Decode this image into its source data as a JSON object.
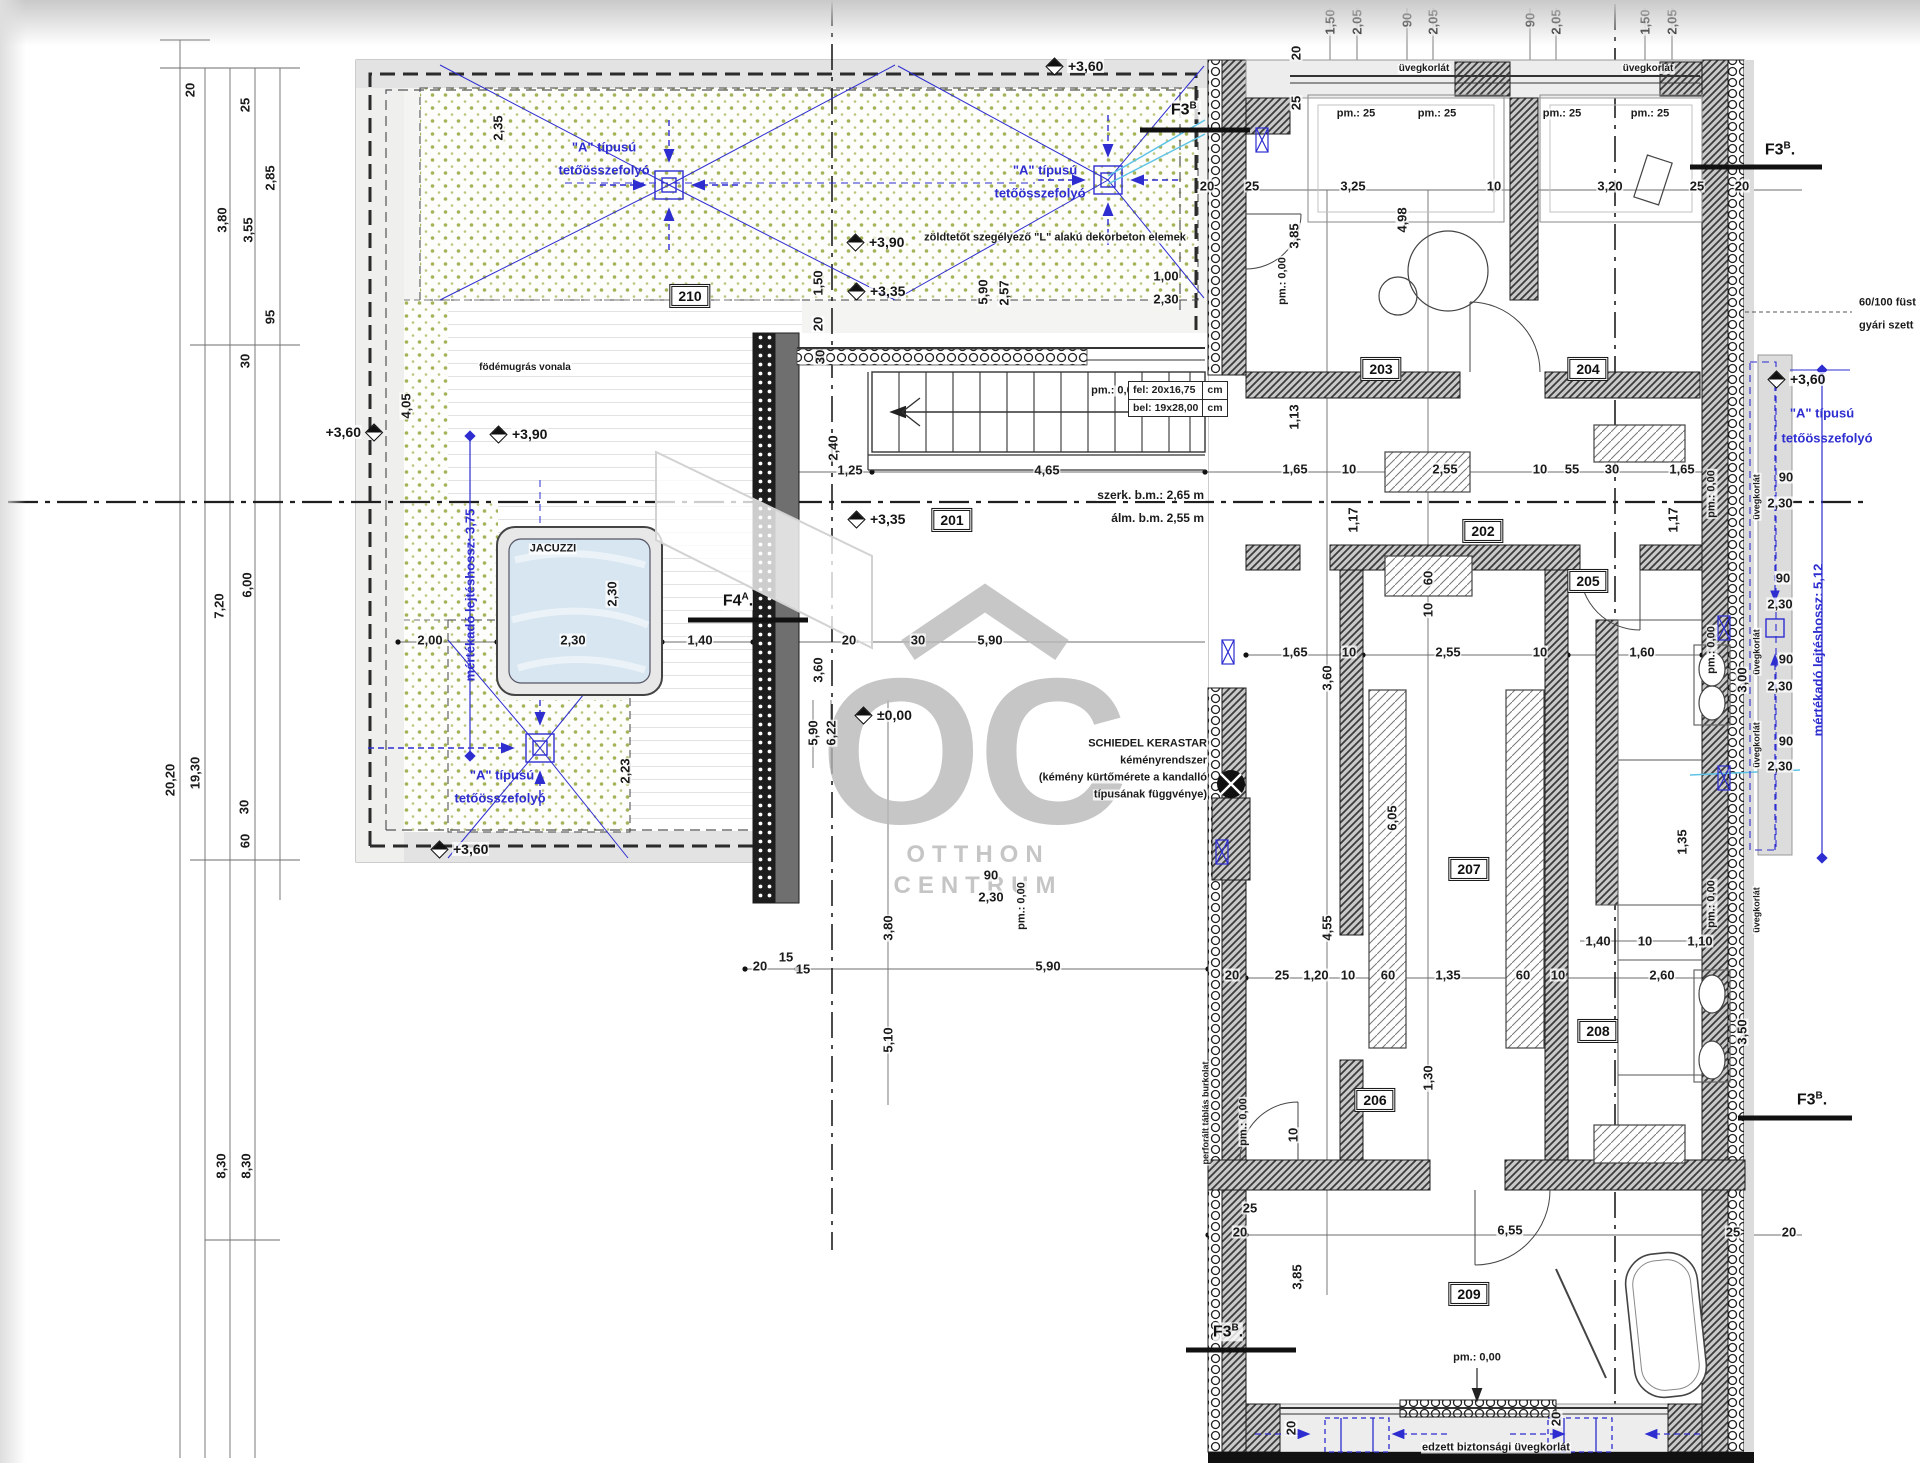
{
  "document": {
    "type": "architectural-floor-plan",
    "language": "hu"
  },
  "colors": {
    "annotation_blue": "#2d2dd0",
    "pipe_cyan": "#5ec4e6",
    "greenroof_dot": "#a6b257",
    "wall_dark": "#3c3c3c"
  },
  "watermark": {
    "logo": "OC",
    "line1": "OTTHON",
    "line2": "CENTRUM"
  },
  "rooms": [
    {
      "id": "201",
      "x": 952,
      "y": 520
    },
    {
      "id": "202",
      "x": 1483,
      "y": 531
    },
    {
      "id": "203",
      "x": 1381,
      "y": 369
    },
    {
      "id": "204",
      "x": 1588,
      "y": 369
    },
    {
      "id": "205",
      "x": 1588,
      "y": 581
    },
    {
      "id": "206",
      "x": 1375,
      "y": 1100
    },
    {
      "id": "207",
      "x": 1469,
      "y": 869
    },
    {
      "id": "208",
      "x": 1598,
      "y": 1031
    },
    {
      "id": "209",
      "x": 1469,
      "y": 1294
    },
    {
      "id": "210",
      "x": 690,
      "y": 296
    }
  ],
  "section_markers": [
    {
      "m": "F3",
      "sup": "B",
      "x": 1186,
      "y": 110
    },
    {
      "m": "F3",
      "sup": "B",
      "x": 1780,
      "y": 150
    },
    {
      "m": "F3",
      "sup": "B",
      "x": 1812,
      "y": 1100
    },
    {
      "m": "F3",
      "sup": "B",
      "x": 1228,
      "y": 1332
    },
    {
      "m": "F4",
      "sup": "A",
      "x": 738,
      "y": 601
    }
  ],
  "elevation_markers": [
    {
      "t": "+3,60",
      "x": 1055,
      "y": 66
    },
    {
      "t": "+3,90",
      "x": 856,
      "y": 242
    },
    {
      "t": "+3,35",
      "x": 857,
      "y": 291
    },
    {
      "t": "+3,60",
      "x": 367,
      "y": 432,
      "side": "l"
    },
    {
      "t": "+3,90",
      "x": 499,
      "y": 434
    },
    {
      "t": "+3,35",
      "x": 857,
      "y": 519
    },
    {
      "t": "±0,00",
      "x": 864,
      "y": 715
    },
    {
      "t": "+3,60",
      "x": 440,
      "y": 849
    },
    {
      "t": "+3,60",
      "x": 1777,
      "y": 379
    }
  ],
  "stair_note": {
    "l1": "fel:",
    "v1": "20x16,75",
    "l2": "bel:",
    "v2": "19x28,00",
    "u1": "cm",
    "u2": "cm"
  },
  "labels": [
    {
      "t": "zöldtetőt szegélyező \"L\" alakú dekorbeton elemek",
      "x": 1055,
      "y": 238,
      "s": 11
    },
    {
      "t": "födémugrás vonala",
      "x": 525,
      "y": 368,
      "s": 10
    },
    {
      "t": "szerk. b.m.: 2,65 m",
      "x": 1205,
      "y": 495,
      "s": 12,
      "a": "r"
    },
    {
      "t": "álm. b.m. 2,55 m",
      "x": 1205,
      "y": 518,
      "s": 12,
      "a": "r"
    },
    {
      "t": "üvegkorlát",
      "x": 1424,
      "y": 69,
      "s": 10
    },
    {
      "t": "üvegkorlát",
      "x": 1648,
      "y": 69,
      "s": 10
    },
    {
      "t": "üvegkorlát",
      "x": 1757,
      "y": 497,
      "s": 9,
      "r": 1
    },
    {
      "t": "üvegkorlát",
      "x": 1757,
      "y": 652,
      "s": 9,
      "r": 1
    },
    {
      "t": "üvegkorlát",
      "x": 1757,
      "y": 745,
      "s": 9,
      "r": 1
    },
    {
      "t": "üvegkorlát",
      "x": 1757,
      "y": 910,
      "s": 9,
      "r": 1
    },
    {
      "t": "perforált táblás burkolat",
      "x": 1206,
      "y": 1113,
      "s": 9,
      "r": 1
    },
    {
      "t": "60/100 füst",
      "x": 1858,
      "y": 303,
      "s": 11,
      "a": "l"
    },
    {
      "t": "gyári szett",
      "x": 1858,
      "y": 326,
      "s": 11,
      "a": "l"
    },
    {
      "t": "JACUZZI",
      "x": 553,
      "y": 549,
      "s": 11
    },
    {
      "t": "SCHIEDEL KERASTAR",
      "x": 1208,
      "y": 744,
      "s": 11,
      "a": "r"
    },
    {
      "t": "kéményrendszer",
      "x": 1208,
      "y": 761,
      "s": 11,
      "a": "r"
    },
    {
      "t": "(kémény kürtőmérete a kandalló",
      "x": 1208,
      "y": 778,
      "s": 11,
      "a": "r"
    },
    {
      "t": "típusának függvénye)",
      "x": 1208,
      "y": 795,
      "s": 11,
      "a": "r"
    },
    {
      "t": "edzett biztonsági üvegkorlát",
      "x": 1496,
      "y": 1448,
      "s": 11
    },
    {
      "t": "pm.: 25",
      "x": 1356,
      "y": 114,
      "s": 11
    },
    {
      "t": "pm.: 25",
      "x": 1437,
      "y": 114,
      "s": 11
    },
    {
      "t": "pm.: 25",
      "x": 1562,
      "y": 114,
      "s": 11
    },
    {
      "t": "pm.: 25",
      "x": 1650,
      "y": 114,
      "s": 11
    },
    {
      "t": "pm.: 0,00",
      "x": 1115,
      "y": 391,
      "s": 11
    },
    {
      "t": "pm.: 0,00",
      "x": 1477,
      "y": 1358,
      "s": 11
    },
    {
      "t": "pm.: 0,00",
      "x": 1283,
      "y": 281,
      "s": 11,
      "r": 1
    },
    {
      "t": "pm.: 0,00",
      "x": 1244,
      "y": 1122,
      "s": 11,
      "r": 1
    },
    {
      "t": "pm.: 0,00",
      "x": 1712,
      "y": 494,
      "s": 11,
      "r": 1
    },
    {
      "t": "pm.: 0,00",
      "x": 1712,
      "y": 650,
      "s": 11,
      "r": 1
    },
    {
      "t": "pm.: 0,00",
      "x": 1712,
      "y": 904,
      "s": 11,
      "r": 1
    },
    {
      "t": "pm.: 0,00",
      "x": 1022,
      "y": 906,
      "s": 11,
      "r": 1
    },
    {
      "t": "\"A\" típusú",
      "x": 604,
      "y": 147,
      "c": "b"
    },
    {
      "t": "tetőösszefolyó",
      "x": 604,
      "y": 170,
      "c": "b"
    },
    {
      "t": "\"A\" típusú",
      "x": 1045,
      "y": 170,
      "c": "b"
    },
    {
      "t": "tetőösszefolyó",
      "x": 1040,
      "y": 193,
      "c": "b"
    },
    {
      "t": "\"A\" típusú",
      "x": 502,
      "y": 775,
      "c": "b"
    },
    {
      "t": "tetőösszefolyó",
      "x": 500,
      "y": 798,
      "c": "b"
    },
    {
      "t": "\"A\" típusú",
      "x": 1822,
      "y": 413,
      "c": "b"
    },
    {
      "t": "tetőösszefolyó",
      "x": 1827,
      "y": 438,
      "c": "b"
    },
    {
      "t": "mértékadó lejtéshossz: 3,75",
      "x": 470,
      "y": 595,
      "c": "b",
      "r": 1
    },
    {
      "t": "mértékadó lejtéshossz: 5,12",
      "x": 1818,
      "y": 650,
      "c": "b",
      "r": 1
    }
  ],
  "dims": [
    {
      "t": "20",
      "x": 190,
      "y": 90,
      "r": 1
    },
    {
      "t": "25",
      "x": 245,
      "y": 105,
      "r": 1
    },
    {
      "t": "2,85",
      "x": 270,
      "y": 178,
      "r": 1
    },
    {
      "t": "3,80",
      "x": 222,
      "y": 220,
      "r": 1
    },
    {
      "t": "3,55",
      "x": 248,
      "y": 230,
      "r": 1
    },
    {
      "t": "95",
      "x": 270,
      "y": 317,
      "r": 1
    },
    {
      "t": "30",
      "x": 245,
      "y": 361,
      "r": 1
    },
    {
      "t": "7,20",
      "x": 219,
      "y": 606,
      "r": 1
    },
    {
      "t": "6,00",
      "x": 247,
      "y": 585,
      "r": 1
    },
    {
      "t": "20,20",
      "x": 170,
      "y": 780,
      "r": 1
    },
    {
      "t": "19,30",
      "x": 195,
      "y": 773,
      "r": 1
    },
    {
      "t": "30",
      "x": 244,
      "y": 807,
      "r": 1
    },
    {
      "t": "60",
      "x": 245,
      "y": 841,
      "r": 1
    },
    {
      "t": "8,30",
      "x": 221,
      "y": 1166,
      "r": 1
    },
    {
      "t": "8,30",
      "x": 246,
      "y": 1166,
      "r": 1
    },
    {
      "t": "1,50",
      "x": 1330,
      "y": 22,
      "r": 1
    },
    {
      "t": "2,05",
      "x": 1357,
      "y": 22,
      "r": 1
    },
    {
      "t": "90",
      "x": 1407,
      "y": 20,
      "r": 1
    },
    {
      "t": "2,05",
      "x": 1433,
      "y": 22,
      "r": 1
    },
    {
      "t": "90",
      "x": 1530,
      "y": 20,
      "r": 1
    },
    {
      "t": "2,05",
      "x": 1556,
      "y": 22,
      "r": 1
    },
    {
      "t": "1,50",
      "x": 1645,
      "y": 22,
      "r": 1
    },
    {
      "t": "2,05",
      "x": 1672,
      "y": 22,
      "r": 1
    },
    {
      "t": "20",
      "x": 1296,
      "y": 53,
      "r": 1
    },
    {
      "t": "25",
      "x": 1296,
      "y": 103,
      "r": 1
    },
    {
      "t": "2,35",
      "x": 498,
      "y": 128,
      "r": 1
    },
    {
      "t": "4,05",
      "x": 406,
      "y": 406,
      "r": 1
    },
    {
      "t": "1,50",
      "x": 818,
      "y": 283,
      "r": 1
    },
    {
      "t": "20",
      "x": 818,
      "y": 324,
      "r": 1
    },
    {
      "t": "30",
      "x": 820,
      "y": 357,
      "r": 1
    },
    {
      "t": "2,40",
      "x": 833,
      "y": 448,
      "r": 1
    },
    {
      "t": "5,90",
      "x": 983,
      "y": 292,
      "r": 1
    },
    {
      "t": "2,57",
      "x": 1004,
      "y": 293,
      "r": 1
    },
    {
      "t": "1,00",
      "x": 1166,
      "y": 276
    },
    {
      "t": "2,30",
      "x": 1166,
      "y": 299
    },
    {
      "t": "2,00",
      "x": 430,
      "y": 640
    },
    {
      "t": "2,30",
      "x": 573,
      "y": 640
    },
    {
      "t": "1,40",
      "x": 700,
      "y": 640
    },
    {
      "t": "20",
      "x": 849,
      "y": 640
    },
    {
      "t": "30",
      "x": 918,
      "y": 640
    },
    {
      "t": "5,90",
      "x": 990,
      "y": 640
    },
    {
      "t": "2,30",
      "x": 612,
      "y": 594,
      "r": 1
    },
    {
      "t": "2,23",
      "x": 625,
      "y": 771,
      "r": 1
    },
    {
      "t": "3,60",
      "x": 818,
      "y": 670,
      "r": 1
    },
    {
      "t": "1,25",
      "x": 850,
      "y": 470
    },
    {
      "t": "4,65",
      "x": 1047,
      "y": 470
    },
    {
      "t": "20",
      "x": 1207,
      "y": 186
    },
    {
      "t": "25",
      "x": 1252,
      "y": 186
    },
    {
      "t": "3,25",
      "x": 1353,
      "y": 186
    },
    {
      "t": "10",
      "x": 1494,
      "y": 186
    },
    {
      "t": "3,20",
      "x": 1610,
      "y": 186
    },
    {
      "t": "25",
      "x": 1697,
      "y": 186
    },
    {
      "t": "20",
      "x": 1742,
      "y": 186
    },
    {
      "t": "3,85",
      "x": 1294,
      "y": 236,
      "r": 1
    },
    {
      "t": "4,98",
      "x": 1402,
      "y": 220,
      "r": 1
    },
    {
      "t": "1,13",
      "x": 1294,
      "y": 417,
      "r": 1
    },
    {
      "t": "1,65",
      "x": 1295,
      "y": 469
    },
    {
      "t": "10",
      "x": 1349,
      "y": 469
    },
    {
      "t": "2,55",
      "x": 1445,
      "y": 469
    },
    {
      "t": "10",
      "x": 1540,
      "y": 469
    },
    {
      "t": "55",
      "x": 1572,
      "y": 469
    },
    {
      "t": "30",
      "x": 1612,
      "y": 469
    },
    {
      "t": "1,65",
      "x": 1682,
      "y": 469
    },
    {
      "t": "1,17",
      "x": 1353,
      "y": 520,
      "r": 1
    },
    {
      "t": "1,17",
      "x": 1673,
      "y": 520,
      "r": 1
    },
    {
      "t": "60",
      "x": 1428,
      "y": 578,
      "r": 1
    },
    {
      "t": "10",
      "x": 1428,
      "y": 610,
      "r": 1
    },
    {
      "t": "1,65",
      "x": 1295,
      "y": 652
    },
    {
      "t": "10",
      "x": 1349,
      "y": 652
    },
    {
      "t": "2,55",
      "x": 1448,
      "y": 652
    },
    {
      "t": "10",
      "x": 1540,
      "y": 652
    },
    {
      "t": "1,60",
      "x": 1642,
      "y": 652
    },
    {
      "t": "3,60",
      "x": 1327,
      "y": 678,
      "r": 1
    },
    {
      "t": "3,00",
      "x": 1742,
      "y": 680,
      "r": 1
    },
    {
      "t": "6,05",
      "x": 1392,
      "y": 818,
      "r": 1
    },
    {
      "t": "1,35",
      "x": 1682,
      "y": 842,
      "r": 1
    },
    {
      "t": "4,55",
      "x": 1327,
      "y": 928,
      "r": 1
    },
    {
      "t": "1,40",
      "x": 1598,
      "y": 941
    },
    {
      "t": "10",
      "x": 1645,
      "y": 941
    },
    {
      "t": "1,10",
      "x": 1700,
      "y": 941
    },
    {
      "t": "2,60",
      "x": 1662,
      "y": 975
    },
    {
      "t": "20",
      "x": 1232,
      "y": 975
    },
    {
      "t": "25",
      "x": 1282,
      "y": 975
    },
    {
      "t": "1,20",
      "x": 1316,
      "y": 975
    },
    {
      "t": "10",
      "x": 1348,
      "y": 975
    },
    {
      "t": "60",
      "x": 1388,
      "y": 975
    },
    {
      "t": "1,35",
      "x": 1448,
      "y": 975
    },
    {
      "t": "60",
      "x": 1523,
      "y": 975
    },
    {
      "t": "10",
      "x": 1558,
      "y": 975
    },
    {
      "t": "1,30",
      "x": 1428,
      "y": 1078,
      "r": 1
    },
    {
      "t": "10",
      "x": 1293,
      "y": 1135,
      "r": 1
    },
    {
      "t": "25",
      "x": 1250,
      "y": 1208
    },
    {
      "t": "3,85",
      "x": 1297,
      "y": 1277,
      "r": 1
    },
    {
      "t": "3,50",
      "x": 1742,
      "y": 1032,
      "r": 1
    },
    {
      "t": "90",
      "x": 991,
      "y": 875
    },
    {
      "t": "2,30",
      "x": 991,
      "y": 897
    },
    {
      "t": "20",
      "x": 1240,
      "y": 1232
    },
    {
      "t": "6,55",
      "x": 1510,
      "y": 1230
    },
    {
      "t": "25",
      "x": 1733,
      "y": 1232
    },
    {
      "t": "20",
      "x": 1789,
      "y": 1232
    },
    {
      "t": "90",
      "x": 1786,
      "y": 477
    },
    {
      "t": "2,30",
      "x": 1780,
      "y": 503
    },
    {
      "t": "90",
      "x": 1783,
      "y": 578
    },
    {
      "t": "2,30",
      "x": 1780,
      "y": 604
    },
    {
      "t": "90",
      "x": 1786,
      "y": 659
    },
    {
      "t": "2,30",
      "x": 1780,
      "y": 686
    },
    {
      "t": "90",
      "x": 1786,
      "y": 741
    },
    {
      "t": "2,30",
      "x": 1780,
      "y": 766
    },
    {
      "t": "20",
      "x": 760,
      "y": 966
    },
    {
      "t": "15",
      "x": 786,
      "y": 957
    },
    {
      "t": "15",
      "x": 803,
      "y": 969
    },
    {
      "t": "5,90",
      "x": 1048,
      "y": 966
    },
    {
      "t": "5,90",
      "x": 813,
      "y": 733,
      "r": 1
    },
    {
      "t": "6,22",
      "x": 831,
      "y": 733,
      "r": 1
    },
    {
      "t": "3,80",
      "x": 888,
      "y": 928,
      "r": 1
    },
    {
      "t": "5,10",
      "x": 888,
      "y": 1040,
      "r": 1
    },
    {
      "t": "20",
      "x": 1291,
      "y": 1428,
      "r": 1
    },
    {
      "t": "20",
      "x": 1556,
      "y": 1419,
      "r": 1
    }
  ]
}
